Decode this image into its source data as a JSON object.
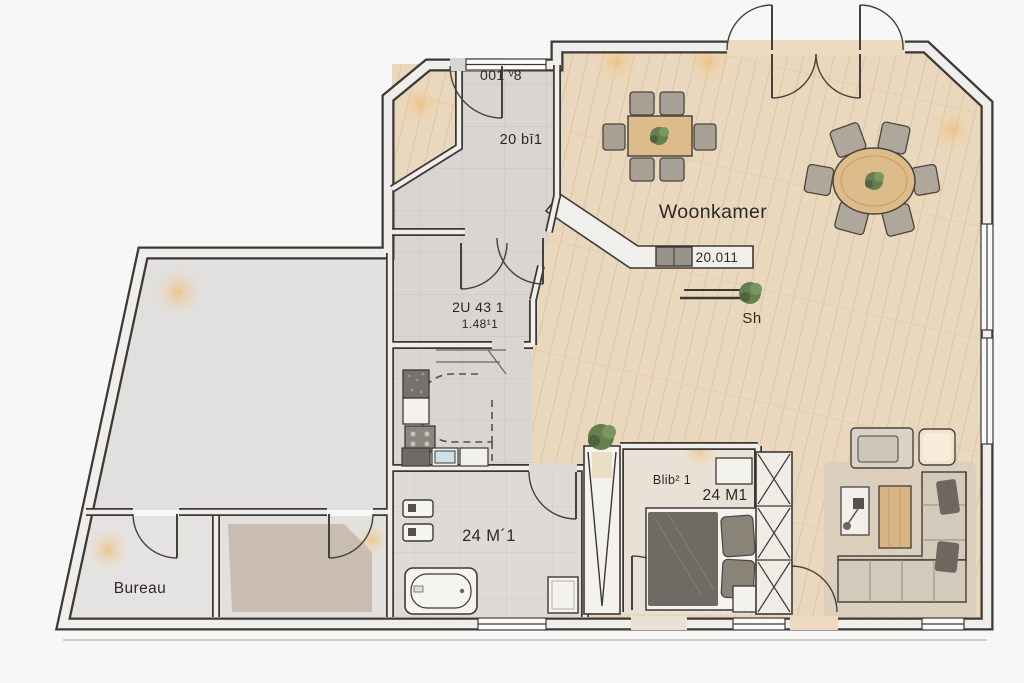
{
  "scene": {
    "type": "floor-plan",
    "style": "top-down architectural rendering"
  },
  "labels": {
    "window_code_top": "001 ᵛ8",
    "entry_hall": "20 bī1",
    "living_room": "Woonkamer",
    "living_room_code": "20.011",
    "shelf": "Sh",
    "hallway_line1": "2U 43 1",
    "hallway_line2": "1.48¹1",
    "bedroom_line1": "Blib² 1",
    "bedroom_line2": "24 M1",
    "bathroom": "24 M´1",
    "office": "Bureau"
  },
  "rooms": [
    "woonkamer",
    "entry-hall",
    "hallway",
    "kitchen-stairs",
    "bathroom",
    "bedroom",
    "bureau",
    "storage-room",
    "carpet-room"
  ],
  "furniture": [
    "dining-table",
    "dining-chairs",
    "oval-table",
    "oval-table-chairs",
    "sideboard",
    "wall-bench",
    "corner-sofa",
    "armchair",
    "pouf",
    "coffee-table",
    "side-table",
    "floor-lamp",
    "area-rug",
    "double-bed",
    "pillows",
    "nightstand",
    "wardrobe-left",
    "wardrobe-right",
    "bathtub",
    "toilet",
    "bidet",
    "shower-tray",
    "kitchen-counter",
    "sink",
    "cooktop",
    "fridge",
    "staircase",
    "plants"
  ],
  "colors": {
    "background": "#f6f6f7",
    "walls": "#3c3835",
    "wall_fill": "#f0eeea",
    "wood_floor": "#ead8be",
    "tile_floor": "#d8d5d2",
    "bath_floor": "#dedbd6",
    "bedroom_floor": "#e9e1d6",
    "carpet": "#c9bdb1",
    "rug": "#d9cdbd",
    "furniture_wood": "#ddbb8a",
    "upholstery": "#aaa198",
    "dark_cushion": "#6e675f",
    "plant_green": "#657f4e",
    "light_glow": "#f2b96a"
  }
}
